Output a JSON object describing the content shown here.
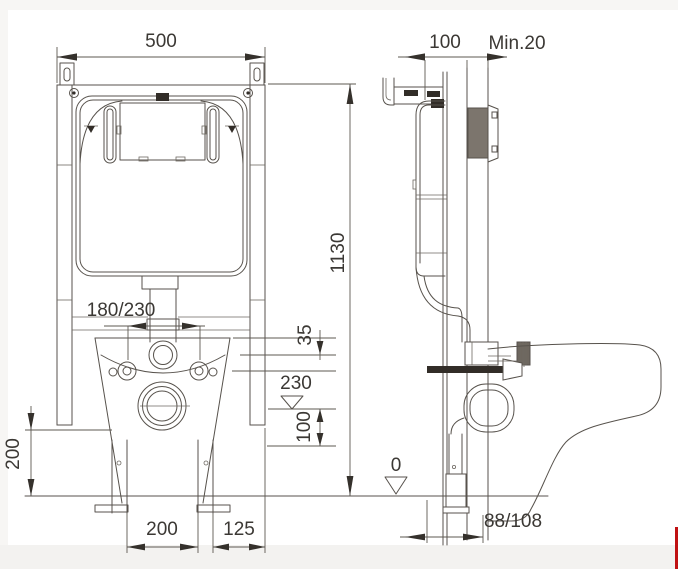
{
  "drawing_type": "wall-hung-toilet-concealed-cistern-installation-diagram",
  "colors": {
    "line": "#57524c",
    "text": "#3b3834",
    "flush_plate_fill": "#7c756d",
    "accent_red_strip": "#c01113",
    "bottom_bar": "#f3f2f0"
  },
  "front_view": {
    "dims": {
      "frame_width": "500",
      "frame_height": "1130",
      "bolt_spacing": "180/230",
      "flush_offset": "35",
      "outlet_level": "230",
      "outlet_offset": "100",
      "lower_height": "200",
      "leg_spacing": "200",
      "leg_to_edge": "125"
    }
  },
  "side_view": {
    "dims": {
      "frame_depth": "100",
      "min_wall_clearance": "Min.20",
      "floor_level": "0",
      "outlet_wall_distance": "88/108"
    }
  }
}
